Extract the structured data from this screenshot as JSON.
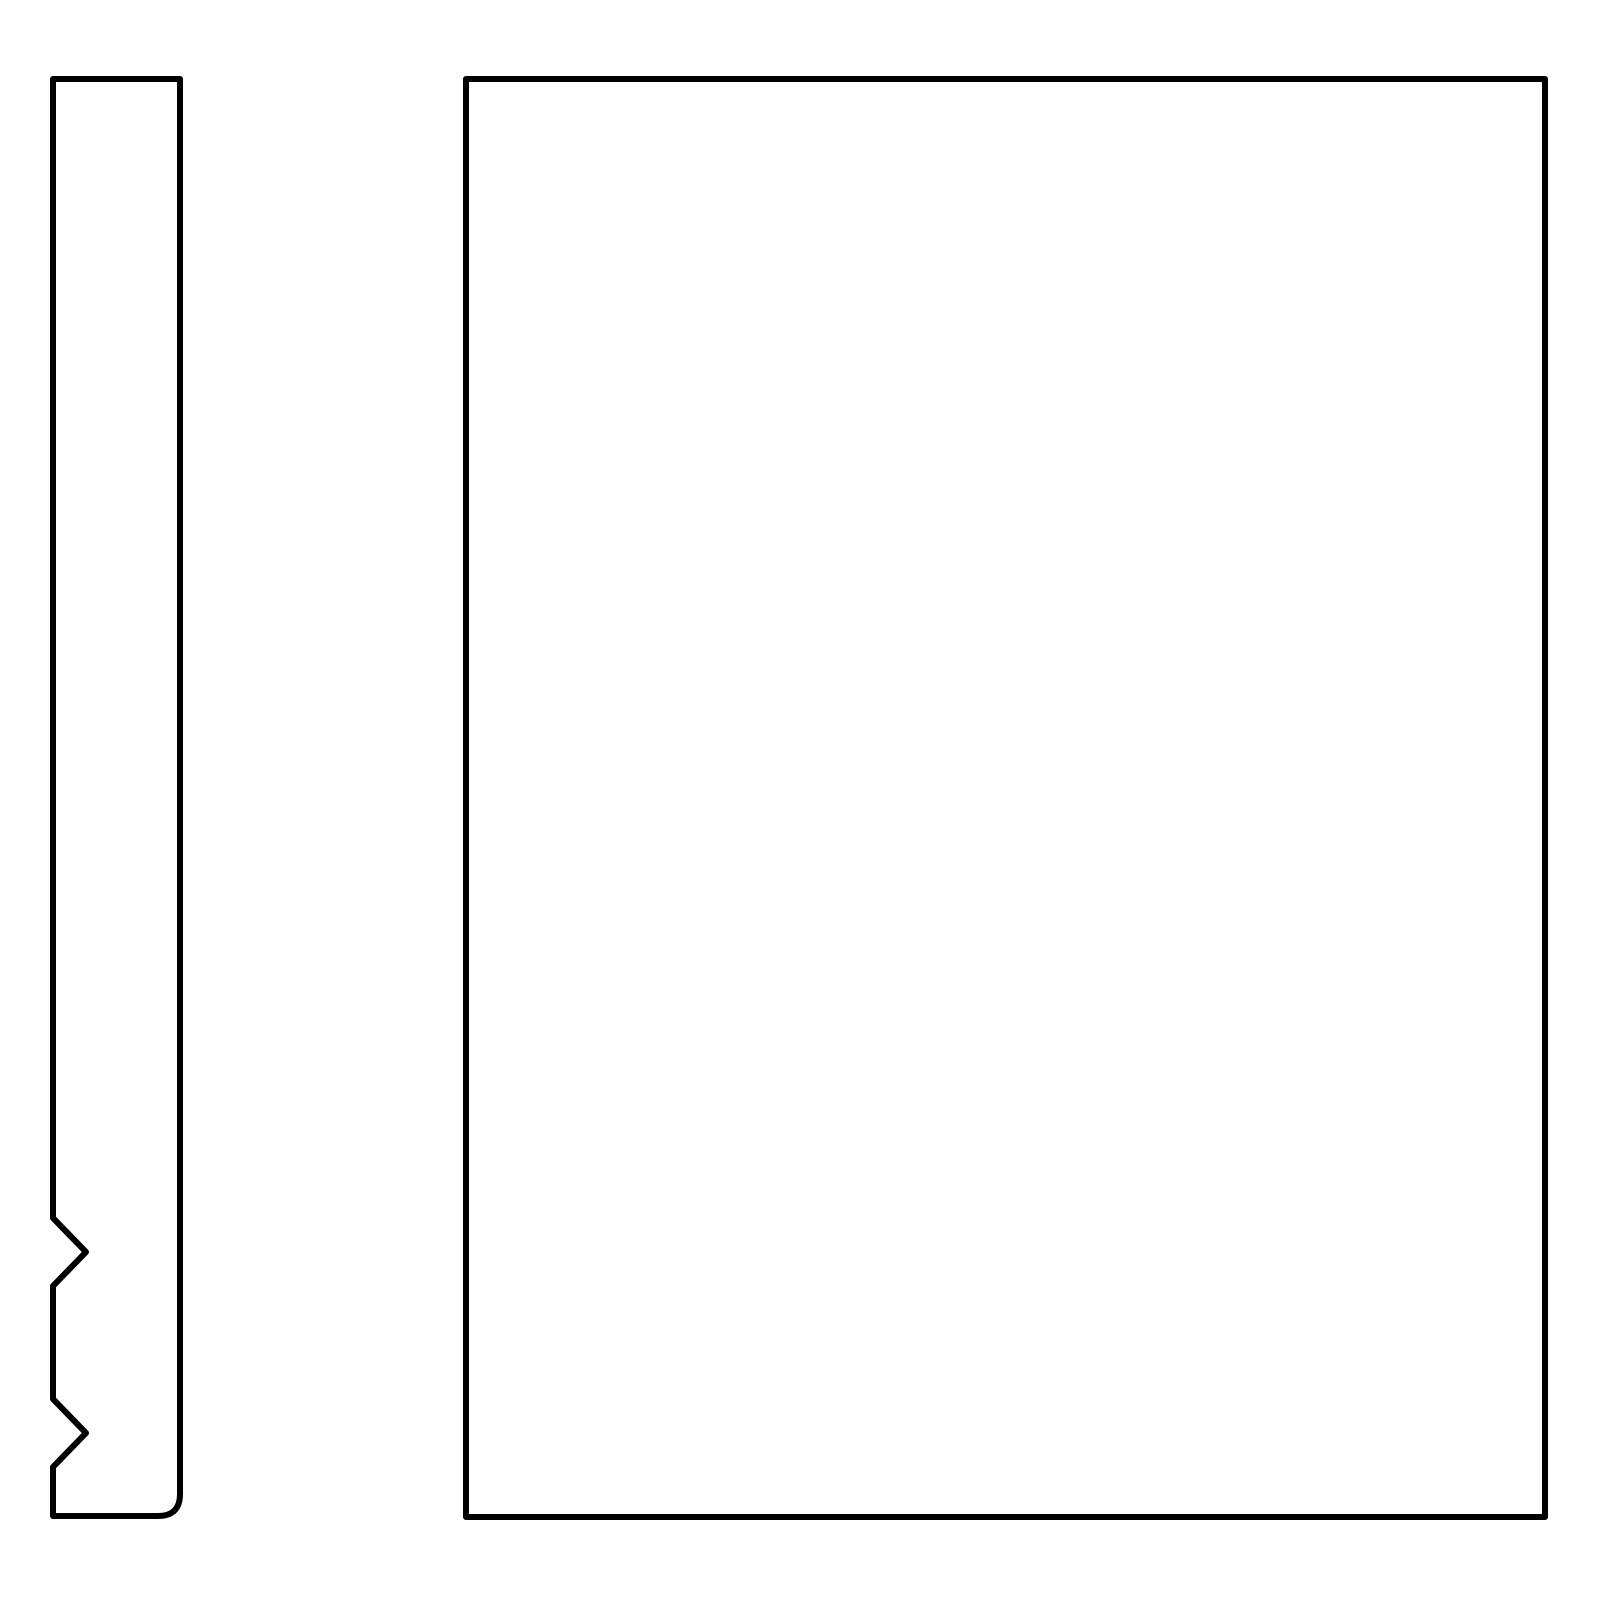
{
  "drawing": {
    "colors": {
      "stroke": "#000000",
      "background": "#ffffff"
    },
    "stroke_width": "6",
    "shapes": {
      "side_profile": {
        "icon_name": "notched-profile-outline",
        "path": "M 53 79 L 180 79 L 180 1494 Q 180 1516 158 1516 L 53 1516 L 53 1467 L 86 1433 L 53 1399 L 53 1286 L 86 1252 L 53 1218 Z"
      },
      "front_face": {
        "icon_name": "rectangle-outline",
        "path": "M 466 79 L 1545 79 L 1545 1517 L 466 1517 Z"
      }
    }
  }
}
